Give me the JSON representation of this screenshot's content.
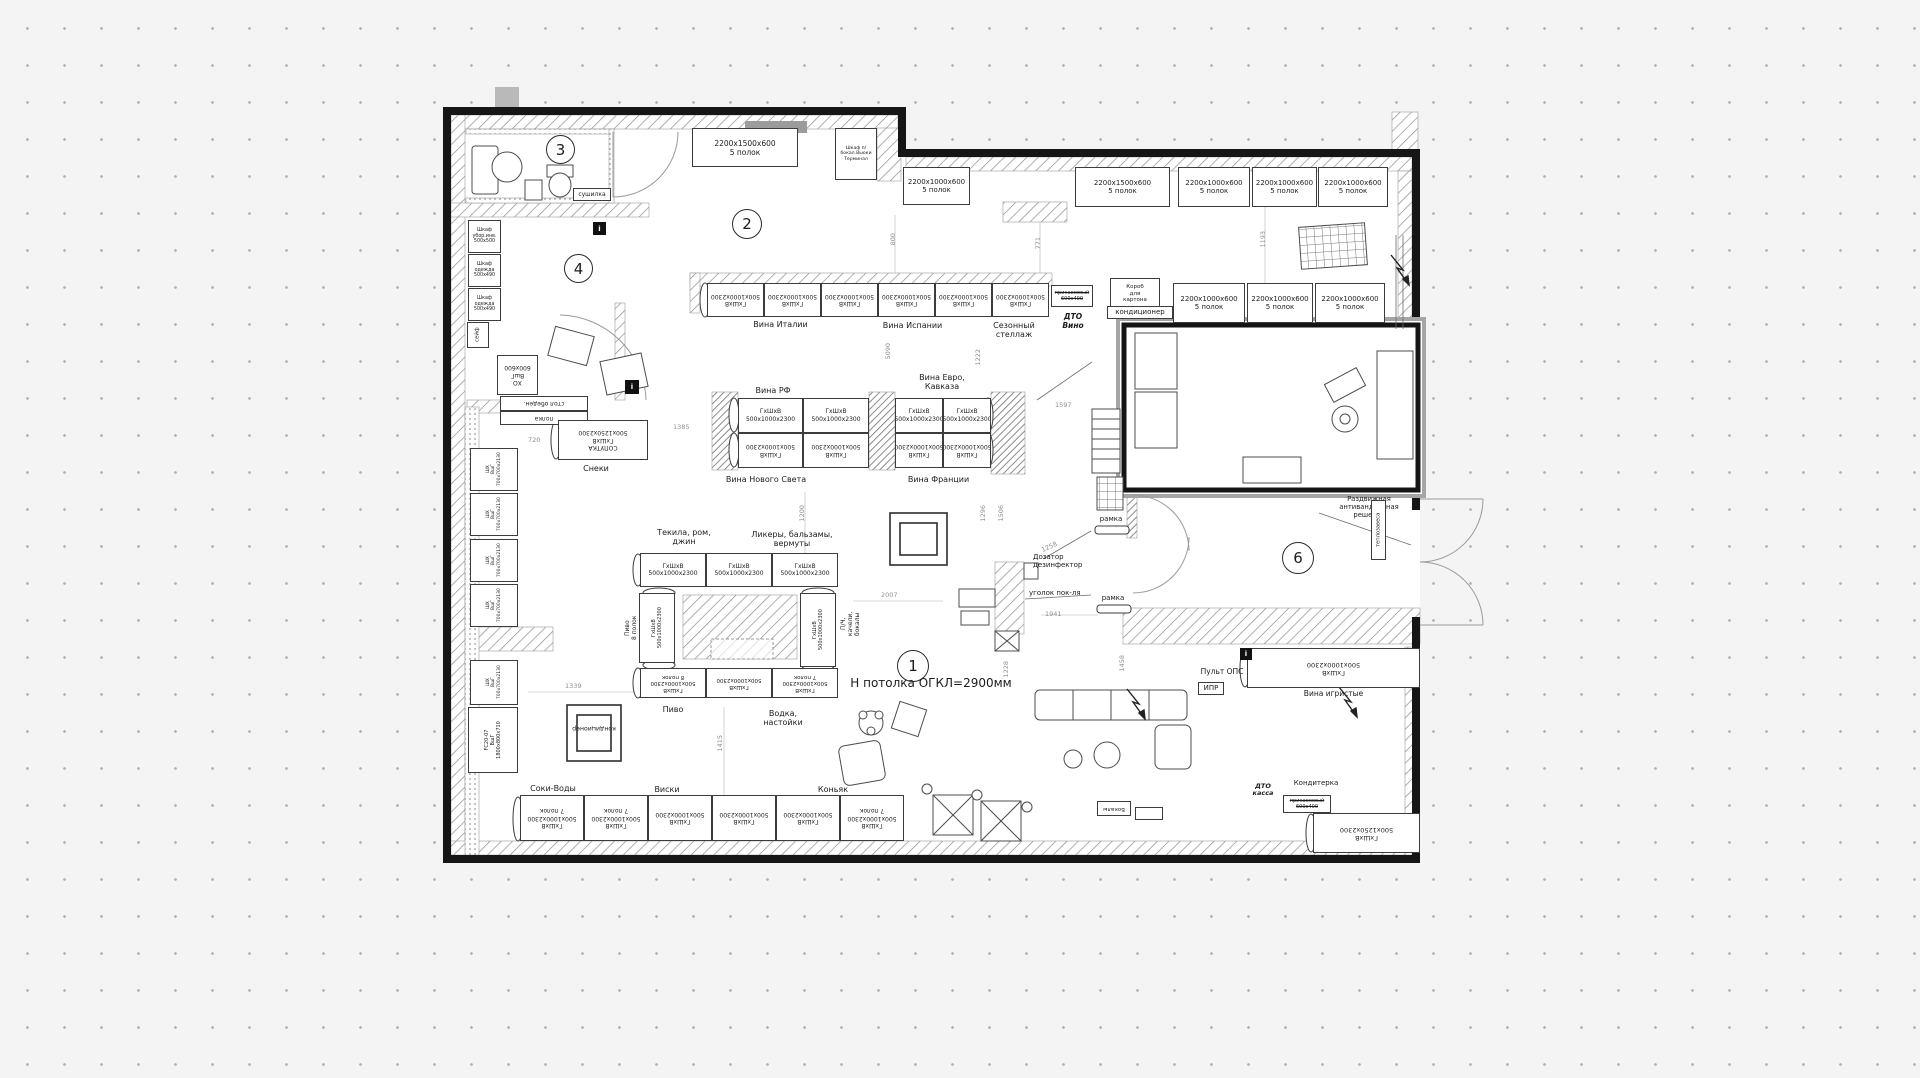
{
  "drawing": {
    "ceiling_note": "Н потолка ОГКЛ=2900мм"
  },
  "rooms": {
    "r1": "1",
    "r2": "2",
    "r3": "3",
    "r4": "4",
    "r6": "6"
  },
  "labels": {
    "shelf_2200_1500": "2200x1500x600\n5 полок",
    "shelf_2200_1000": "2200x1000x600\n5 полок",
    "rack_std": "ГхШхВ\n500x1000x2300",
    "rack_std_7": "ГхШхВ\n500x1000x2300\n7 полок",
    "rack_std_8": "ГхШхВ\n500x1000x2300\n8 полок",
    "rack_soputka": "СОПУТКА\nГхШхВ\n500x1250x2300",
    "rack_1250": "ГхШхВ\n500x1250x2300",
    "fridge_shx": "ШХ\nВшГ\n700x700x2130",
    "fridge_fc": "FC20-07\nВшГ\n1800x800x710",
    "fridge_xo": "ХО\nВшГ\n600x600",
    "cab_ubor": "Шкаф\nубор.инв.\n500x500",
    "cab_odezhda": "Шкаф\nодежда\n500x490",
    "safe": "сейф",
    "dryer": "сушилка",
    "closet_top": "Шкаф п/\nбокал.Вьюки\nТерминал",
    "korob": "Короб\nдля\nкартона",
    "kondicioner": "кондиционер",
    "stol_obed": "стол обеден.",
    "polka": "полка",
    "snacks": "Снеки",
    "wine_italy": "Вина Италии",
    "wine_spain": "Вина Испании",
    "seasonal": "Сезонный\nстеллаж",
    "dto_wine": "ДТО\nВино",
    "dto_kassa": "ДТО\nкасса",
    "prikass": "прикассовый\n600x400",
    "wine_rf": "Вина РФ",
    "wine_euro": "Вина Евро,\nКавказа",
    "wine_new_world": "Вина Нового Света",
    "wine_france": "Вина Франции",
    "tequila": "Текила, ром,\nджин",
    "liquors": "Ликеры, бальзамы,\nвермуты",
    "beer_vert": "Пиво\n8 полок",
    "beer": "Пиво",
    "vodka": "Водка,\nнастойки",
    "whiskey": "Виски",
    "cognac": "Коньяк",
    "juices": "Соки-Воды",
    "pch": "П/Ч,\nкачели,\nбокалы",
    "ramka": "рамка",
    "dozator": "Дозатор\nдезинфектор",
    "ugolok": "уголок пок-ля",
    "pult": "Пульт ОПС",
    "ipr": "ИПР",
    "grille": "Раздвижная\nантивандальная\nрешетка",
    "teplozavesa": "теплозавеса",
    "wine_sparkling": "Вина игристые",
    "konditerka": "Кондитерка",
    "bokaly": "Бокалы",
    "info": "i"
  },
  "dims": {
    "d800": "800",
    "d771": "771",
    "d1193": "1193",
    "d5090": "5090",
    "d1222": "1222",
    "d1597": "1597",
    "d1385": "1385",
    "d720": "720",
    "d1296": "1296",
    "d1506": "1506",
    "d1258": "1258",
    "d1941": "1941",
    "d2007": "2007",
    "d1200": "1200",
    "d1228": "1228",
    "d1458": "1458",
    "d1339": "1339",
    "d1415": "1415"
  }
}
